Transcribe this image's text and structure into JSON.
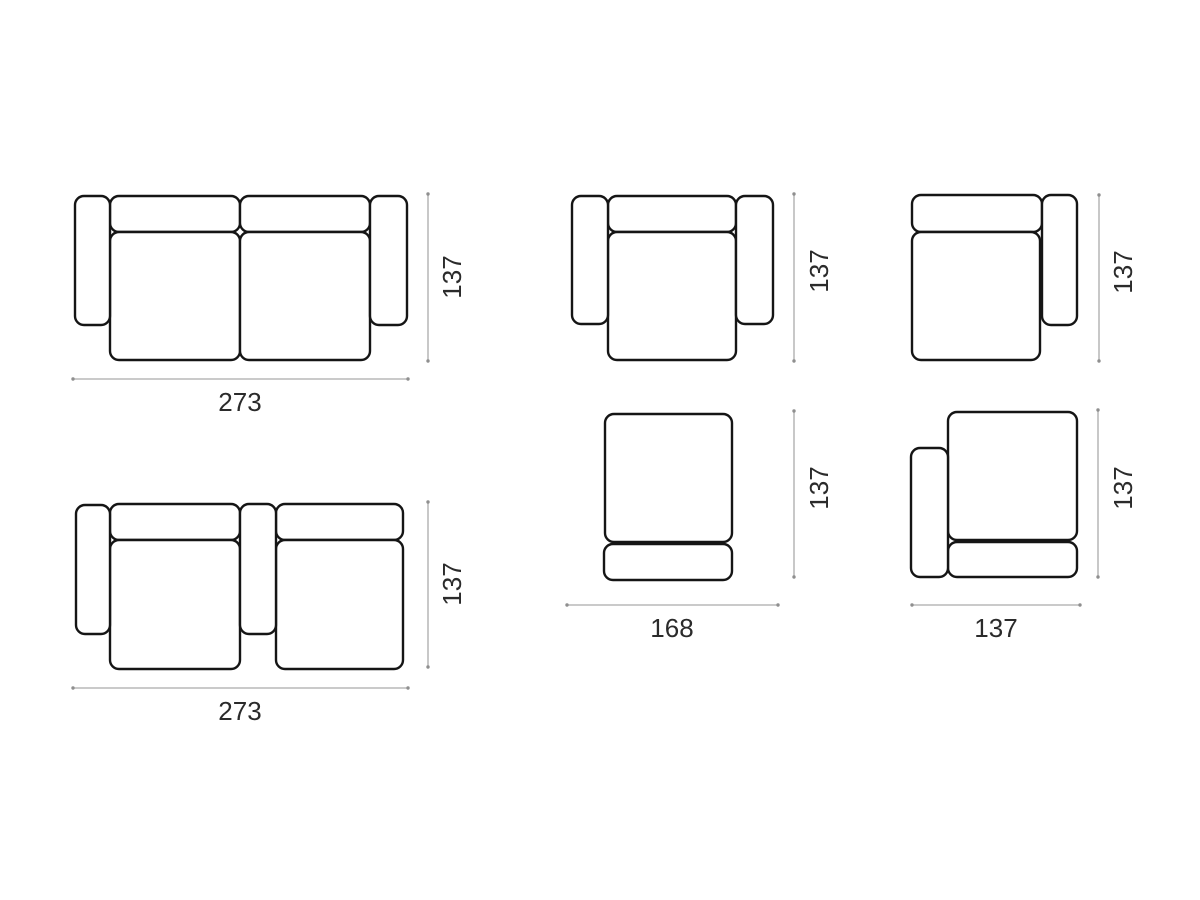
{
  "colors": {
    "background": "#ffffff",
    "outline": "#151515",
    "dimension_line": "#ababab",
    "label_text": "#2b2b2b"
  },
  "diagrams": [
    {
      "name": "two-seat-sofa-both-arms",
      "width": "273",
      "depth": "137"
    },
    {
      "name": "armchair-both-arms",
      "depth": "137"
    },
    {
      "name": "seat-module-right-arm",
      "depth": "137"
    },
    {
      "name": "two-seat-sofa-center-arm",
      "width": "273",
      "depth": "137"
    },
    {
      "name": "ottoman",
      "width": "168",
      "depth": "137"
    },
    {
      "name": "seat-module-left-arm",
      "width": "137",
      "depth": "137"
    }
  ]
}
